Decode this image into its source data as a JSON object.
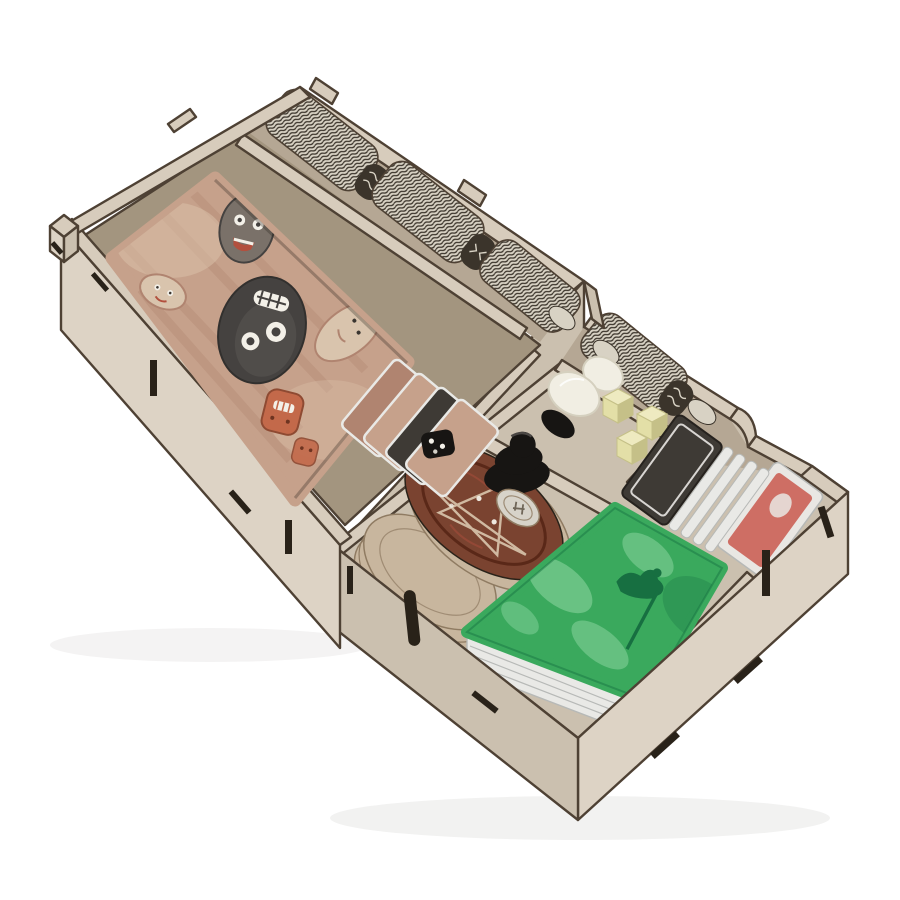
{
  "canvas": {
    "width": 900,
    "height": 900,
    "background": "#ffffff"
  },
  "photo": {
    "subject": "Laser-cut wooden board game box insert organizer filled with game components",
    "material": "light beige plywood with dark laser-burnt edges and finger-joint notches",
    "setting": "angled product shot on seamless white background",
    "text_visible": "none"
  },
  "colors": {
    "bg": "#ffffff",
    "wood_top": "#d7ccbc",
    "wood_light": "#ddd3c5",
    "wood_mid": "#cbc0af",
    "wood_shade": "#b5a794",
    "wood_deep": "#a3957f",
    "edge_dark": "#4e4134",
    "edge_deep": "#292219",
    "card_base": "#c6a18b",
    "card_grain": "#b08470",
    "card_light": "#dcc3ac",
    "mask_dark": "#454240",
    "mask_gray": "#7a7169",
    "mask_pale": "#d9c4ad",
    "mask_red": "#b2503e",
    "mask_orange": "#c3694a",
    "eye_white": "#f3f0e8",
    "token_light": "#d8d2c4",
    "token_dark": "#3b342b",
    "green_main": "#3aa95d",
    "green_light": "#90d7a3",
    "green_dark": "#176f41",
    "deck_edge": "#e9e9e6",
    "deck_line": "#b7b9b7",
    "disc_top": "#7a4330",
    "disc_art": "#5a2818",
    "disc_rim": "#c8b69e",
    "disc_line": "#8f7b62",
    "black": "#171513",
    "black_hi": "#4b4744",
    "ivory": "#f1eee3",
    "ivory_shade": "#d5d0bf",
    "cream": "#e3dfa7",
    "cream_dark": "#c5c088",
    "cream_light": "#eeeac0",
    "silver": "#d7d3c9",
    "card_red": "#ce6e64",
    "card_white": "#e9e7e3",
    "card_dark": "#3e3a35",
    "star": "#d9c6ae",
    "shadow": "#1e1a15"
  },
  "components": {
    "upper_tray": {
      "name": "raised card tray",
      "items": [
        {
          "name": "mask-card-deck",
          "label": "deck of large cards with tribal mask artwork",
          "count": 1
        },
        {
          "name": "wavy-token-stacks",
          "label": "stacks of wavy-edged cardboard tokens in slots",
          "count": 3
        },
        {
          "name": "leaning-reference-cards",
          "label": "small wooden-art cards leaning in front slot",
          "count": 4
        },
        {
          "name": "black-die",
          "label": "black die with white pips",
          "count": 1
        }
      ]
    },
    "lower_tray": {
      "name": "low component tray",
      "items": [
        {
          "name": "wavy-token-stack",
          "label": "stack of wavy-edged tokens with loose coins",
          "count": 1
        },
        {
          "name": "voodoo-disc-stack",
          "label": "round wooden discs with star artwork",
          "count": 2
        },
        {
          "name": "black-pawn",
          "label": "black wooden pawn lying on its side",
          "count": 1
        },
        {
          "name": "black-discs",
          "label": "black wooden discs",
          "count": 2
        },
        {
          "name": "silver-token",
          "label": "pale engraved token",
          "count": 1
        },
        {
          "name": "ivory-tokens",
          "label": "ivory rounded tokens",
          "count": 2
        },
        {
          "name": "cream-cubes",
          "label": "pale yellow wooden cubes",
          "count": 3
        },
        {
          "name": "green-card-deck",
          "label": "deck of green landscape cards",
          "count": 1
        },
        {
          "name": "small-card-stack",
          "label": "stack of small cards with red and white faces",
          "count": 1
        }
      ]
    }
  }
}
